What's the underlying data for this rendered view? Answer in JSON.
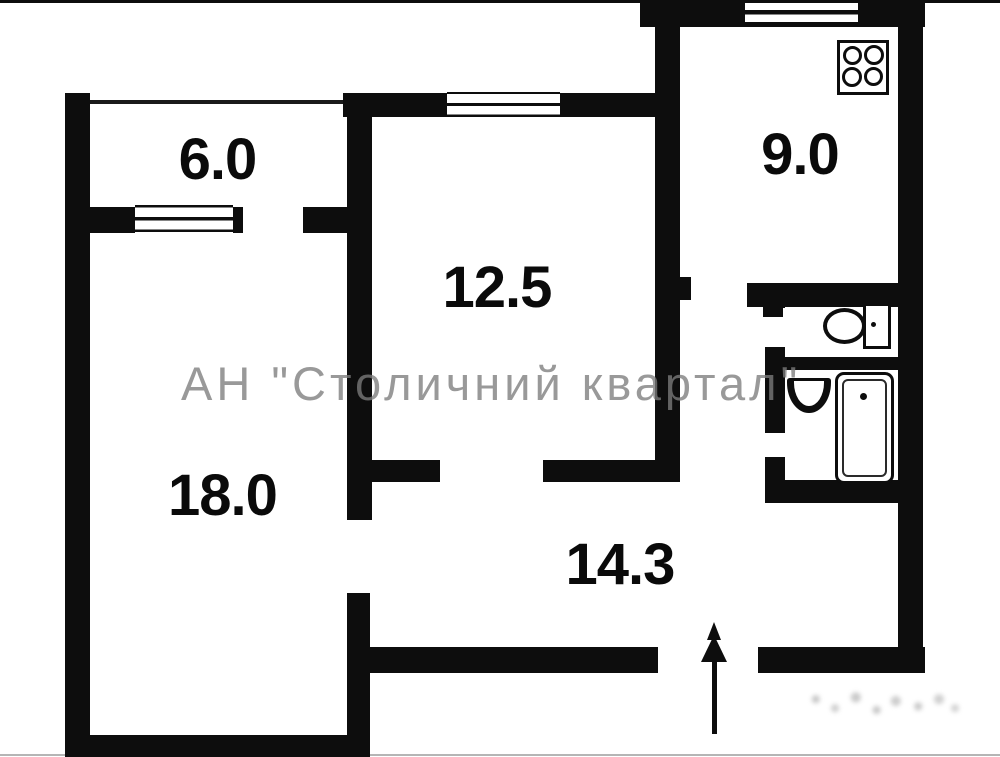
{
  "plan": {
    "type": "apartment-floor-plan",
    "watermark": "АН \"Столичний квартал\"",
    "rooms": [
      {
        "id": "balcony",
        "area": "6.0"
      },
      {
        "id": "living-room",
        "area": "18.0"
      },
      {
        "id": "bedroom",
        "area": "12.5"
      },
      {
        "id": "kitchen",
        "area": "9.0"
      },
      {
        "id": "hallway",
        "area": "14.3"
      }
    ],
    "fixtures": [
      "stove-icon",
      "toilet-icon",
      "sink-icon",
      "bathtub-icon",
      "entrance-arrow"
    ],
    "colors": {
      "wall": "#0d0d0d",
      "background": "#ffffff",
      "watermark": "#7c7c7c"
    }
  }
}
